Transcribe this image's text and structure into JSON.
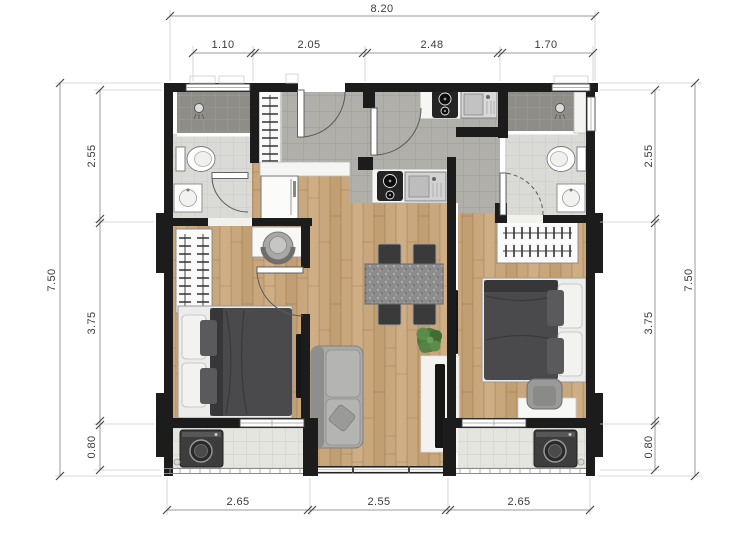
{
  "plan": {
    "title": "two-bedroom apartment floor plan",
    "dimensions": {
      "top": {
        "total": "8.20",
        "segments": [
          "1.10",
          "2.05",
          "2.48",
          "1.70"
        ]
      },
      "bottom": {
        "segments": [
          "2.65",
          "2.55",
          "2.65"
        ]
      },
      "left": {
        "total": "7.50",
        "segments": [
          "2.55",
          "3.75",
          "0.80"
        ]
      },
      "right": {
        "total": "7.50",
        "segments": [
          "2.55",
          "3.75",
          "0.80"
        ]
      }
    },
    "colors": {
      "wall": "#1c1c1c",
      "wood_floor": "#c9a77d",
      "hall_tile": "#b3b1ab",
      "bath_tile": "#dcdcd8",
      "shower_tile": "#908e89",
      "balcony_tile": "#e6e6e0",
      "dimension_text": "#3a3a3a",
      "plant_green": "#4a7a3e",
      "furniture_dark": "#4a4a4c"
    },
    "rooms": {
      "bathroom_left": {
        "fixtures": [
          "shower",
          "toilet",
          "vanity-sink",
          "window",
          "swing-door"
        ]
      },
      "bathroom_right": {
        "fixtures": [
          "shower",
          "toilet",
          "vanity-sink",
          "window",
          "swing-door"
        ]
      },
      "entry_kitchen": {
        "fixtures": [
          "entry-door",
          "hall-closet",
          "refrigerator",
          "shoe-cabinet",
          "cooktop",
          "kitchen-sink",
          "second-cooktop",
          "second-kitchen-sink",
          "inner-door"
        ]
      },
      "living_dining": {
        "fixtures": [
          "dining-table",
          "four-chairs",
          "plant",
          "sofa",
          "tv-console",
          "picture-window"
        ]
      },
      "bedroom_left": {
        "fixtures": [
          "wardrobe",
          "desk",
          "desk-chair",
          "double-bed",
          "wall-tv",
          "window"
        ]
      },
      "bedroom_right": {
        "fixtures": [
          "wardrobe",
          "double-bed",
          "wall-tv",
          "armchair",
          "window"
        ]
      },
      "balcony_left": {
        "fixtures": [
          "washing-machine",
          "floor-drain",
          "railing"
        ]
      },
      "balcony_right": {
        "fixtures": [
          "washing-machine",
          "floor-drain",
          "railing"
        ]
      }
    }
  }
}
